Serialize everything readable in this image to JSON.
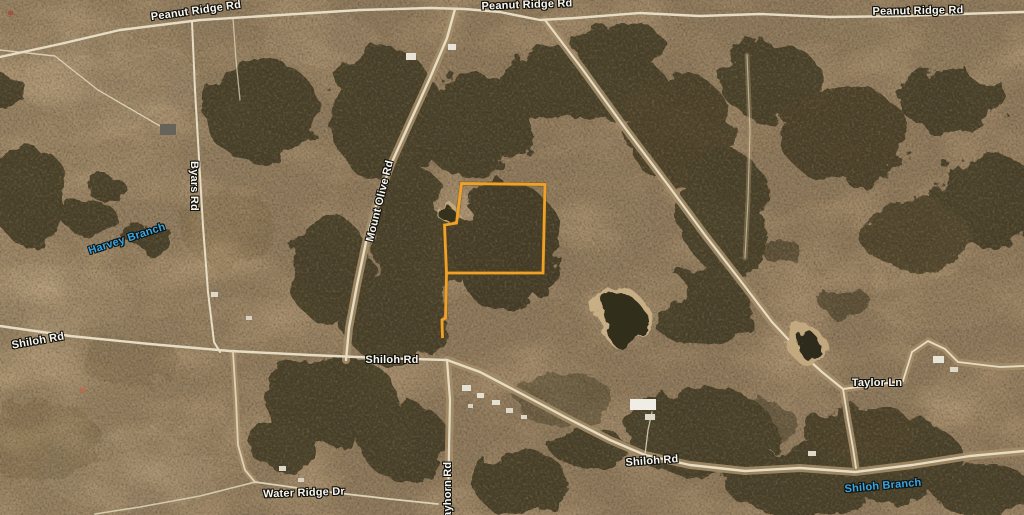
{
  "map": {
    "road_labels": [
      {
        "name": "peanut-ridge-rd-west",
        "text": "Peanut Ridge Rd"
      },
      {
        "name": "peanut-ridge-rd-center",
        "text": "Peanut Ridge Rd"
      },
      {
        "name": "peanut-ridge-rd-east",
        "text": "Peanut Ridge Rd"
      },
      {
        "name": "byars-rd",
        "text": "Byars Rd"
      },
      {
        "name": "mount-olive-rd",
        "text": "Mount Olive Rd"
      },
      {
        "name": "shiloh-rd-west",
        "text": "Shiloh Rd"
      },
      {
        "name": "shiloh-rd-center",
        "text": "Shiloh Rd"
      },
      {
        "name": "shiloh-rd-south",
        "text": "Shiloh Rd"
      },
      {
        "name": "taylor-ln",
        "text": "Taylor Ln"
      },
      {
        "name": "water-ridge-dr",
        "text": "Water Ridge Dr"
      },
      {
        "name": "grayhorn-rd-partial",
        "text": "rayhorn Rd"
      }
    ],
    "water_labels": [
      {
        "name": "harvey-branch",
        "text": "Harvey Branch"
      },
      {
        "name": "shiloh-branch",
        "text": "Shiloh Branch"
      }
    ],
    "parcel": {
      "outline_color": "#f0a228"
    },
    "label_colors": {
      "road": "#f8f6ef",
      "water": "#35a7e5"
    }
  }
}
